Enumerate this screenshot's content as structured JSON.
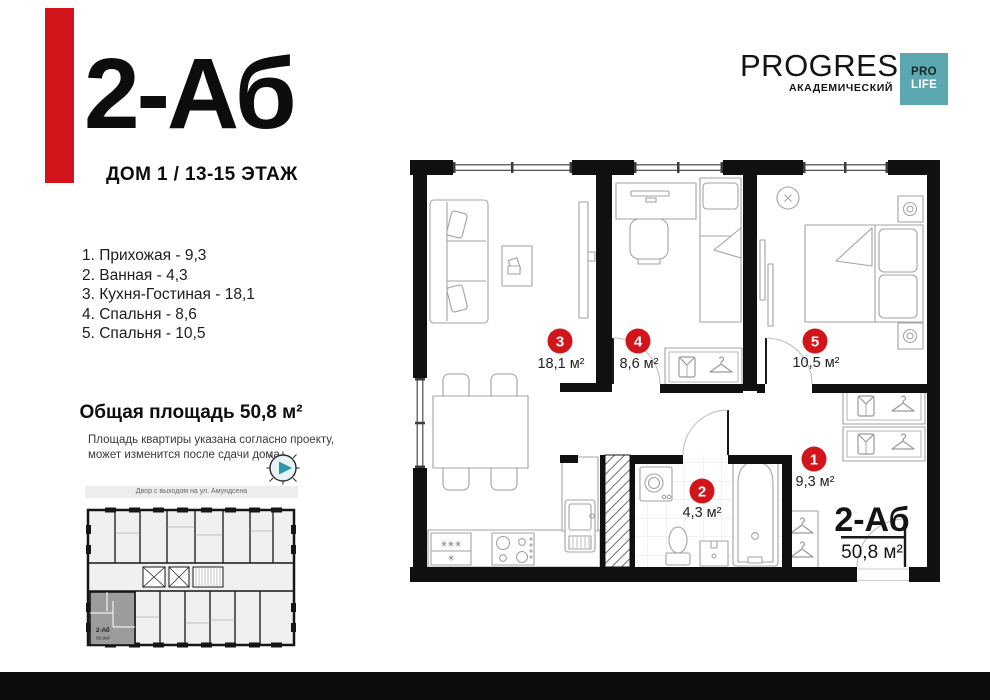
{
  "title": {
    "code": "2-Аб",
    "subtitle": "ДОМ 1 / 13-15 ЭТАЖ"
  },
  "brand": {
    "name": "PROGRESS",
    "district": "АКАДЕМИЧЕСКИЙ",
    "badge_top": "PRO",
    "badge_bottom": "LIFE"
  },
  "room_list": [
    {
      "line": "1. Прихожая - 9,3"
    },
    {
      "line": "2. Ванная - 4,3"
    },
    {
      "line": "3. Кухня-Гостиная - 18,1"
    },
    {
      "line": "4. Спальня - 8,6"
    },
    {
      "line": "5. Спальня - 10,5"
    }
  ],
  "total_area": "Общая площадь 50,8 м²",
  "note": {
    "line1": "Площадь квартиры указана согласно проекту,",
    "line2": "может изменится после сдачи дома"
  },
  "mini_plan": {
    "street": "Двор с выходом на ул. Амундсена",
    "unit_code": "2-Аб",
    "unit_area": "50,8м²"
  },
  "plan": {
    "unit_code": "2-Аб",
    "unit_area": "50,8 м²",
    "fridge_marks": "✳✳✳",
    "fridge_mark": "✳",
    "markers": [
      {
        "num": "1",
        "area": "9,3 м²"
      },
      {
        "num": "2",
        "area": "4,3 м²"
      },
      {
        "num": "3",
        "area": "18,1 м²"
      },
      {
        "num": "4",
        "area": "8,6 м²"
      },
      {
        "num": "5",
        "area": "10,5 м²"
      }
    ]
  },
  "colors": {
    "red": "#d2151b",
    "teal": "#5da7b0",
    "wall": "#101010",
    "unit_gray": "#9c9c9c"
  }
}
